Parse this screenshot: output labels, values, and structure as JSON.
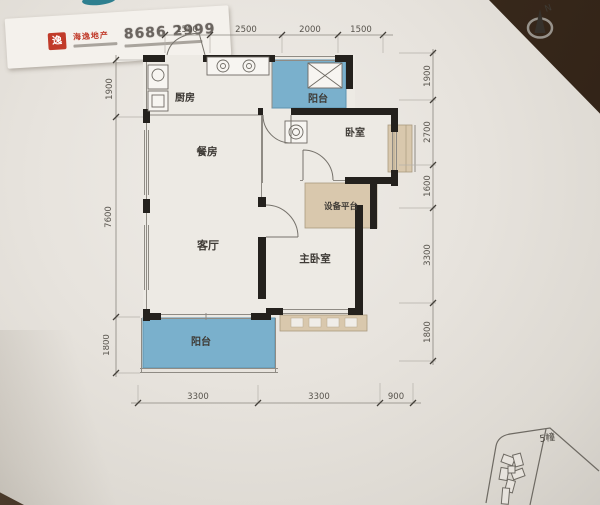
{
  "business_card": {
    "logo_glyph": "逸",
    "brand": "海逸地产",
    "phone": "8686 2999"
  },
  "compass": {
    "label": "N"
  },
  "plan": {
    "rooms": {
      "kitchen": "厨房",
      "balcony_top": "阳台",
      "bedroom": "卧室",
      "dining": "餐房",
      "equipment": "设备平台",
      "living": "客厅",
      "master": "主卧室",
      "balcony_bottom": "阳台"
    },
    "dims": {
      "top": [
        "1500",
        "2500",
        "2000",
        "1500"
      ],
      "bottom": [
        "3300",
        "3300",
        "900"
      ],
      "left": [
        "1900",
        "7600",
        "1800"
      ],
      "right": [
        "1900",
        "2700",
        "1600",
        "3300",
        "1800"
      ]
    }
  },
  "site_plan": {
    "label": "5幢"
  },
  "colors": {
    "balcony_fill": "#7ab0cc",
    "platform_fill": "#d9c8ad",
    "wall": "#24211d",
    "paper": "#e7e3dd",
    "brand_red": "#c13b2a"
  }
}
